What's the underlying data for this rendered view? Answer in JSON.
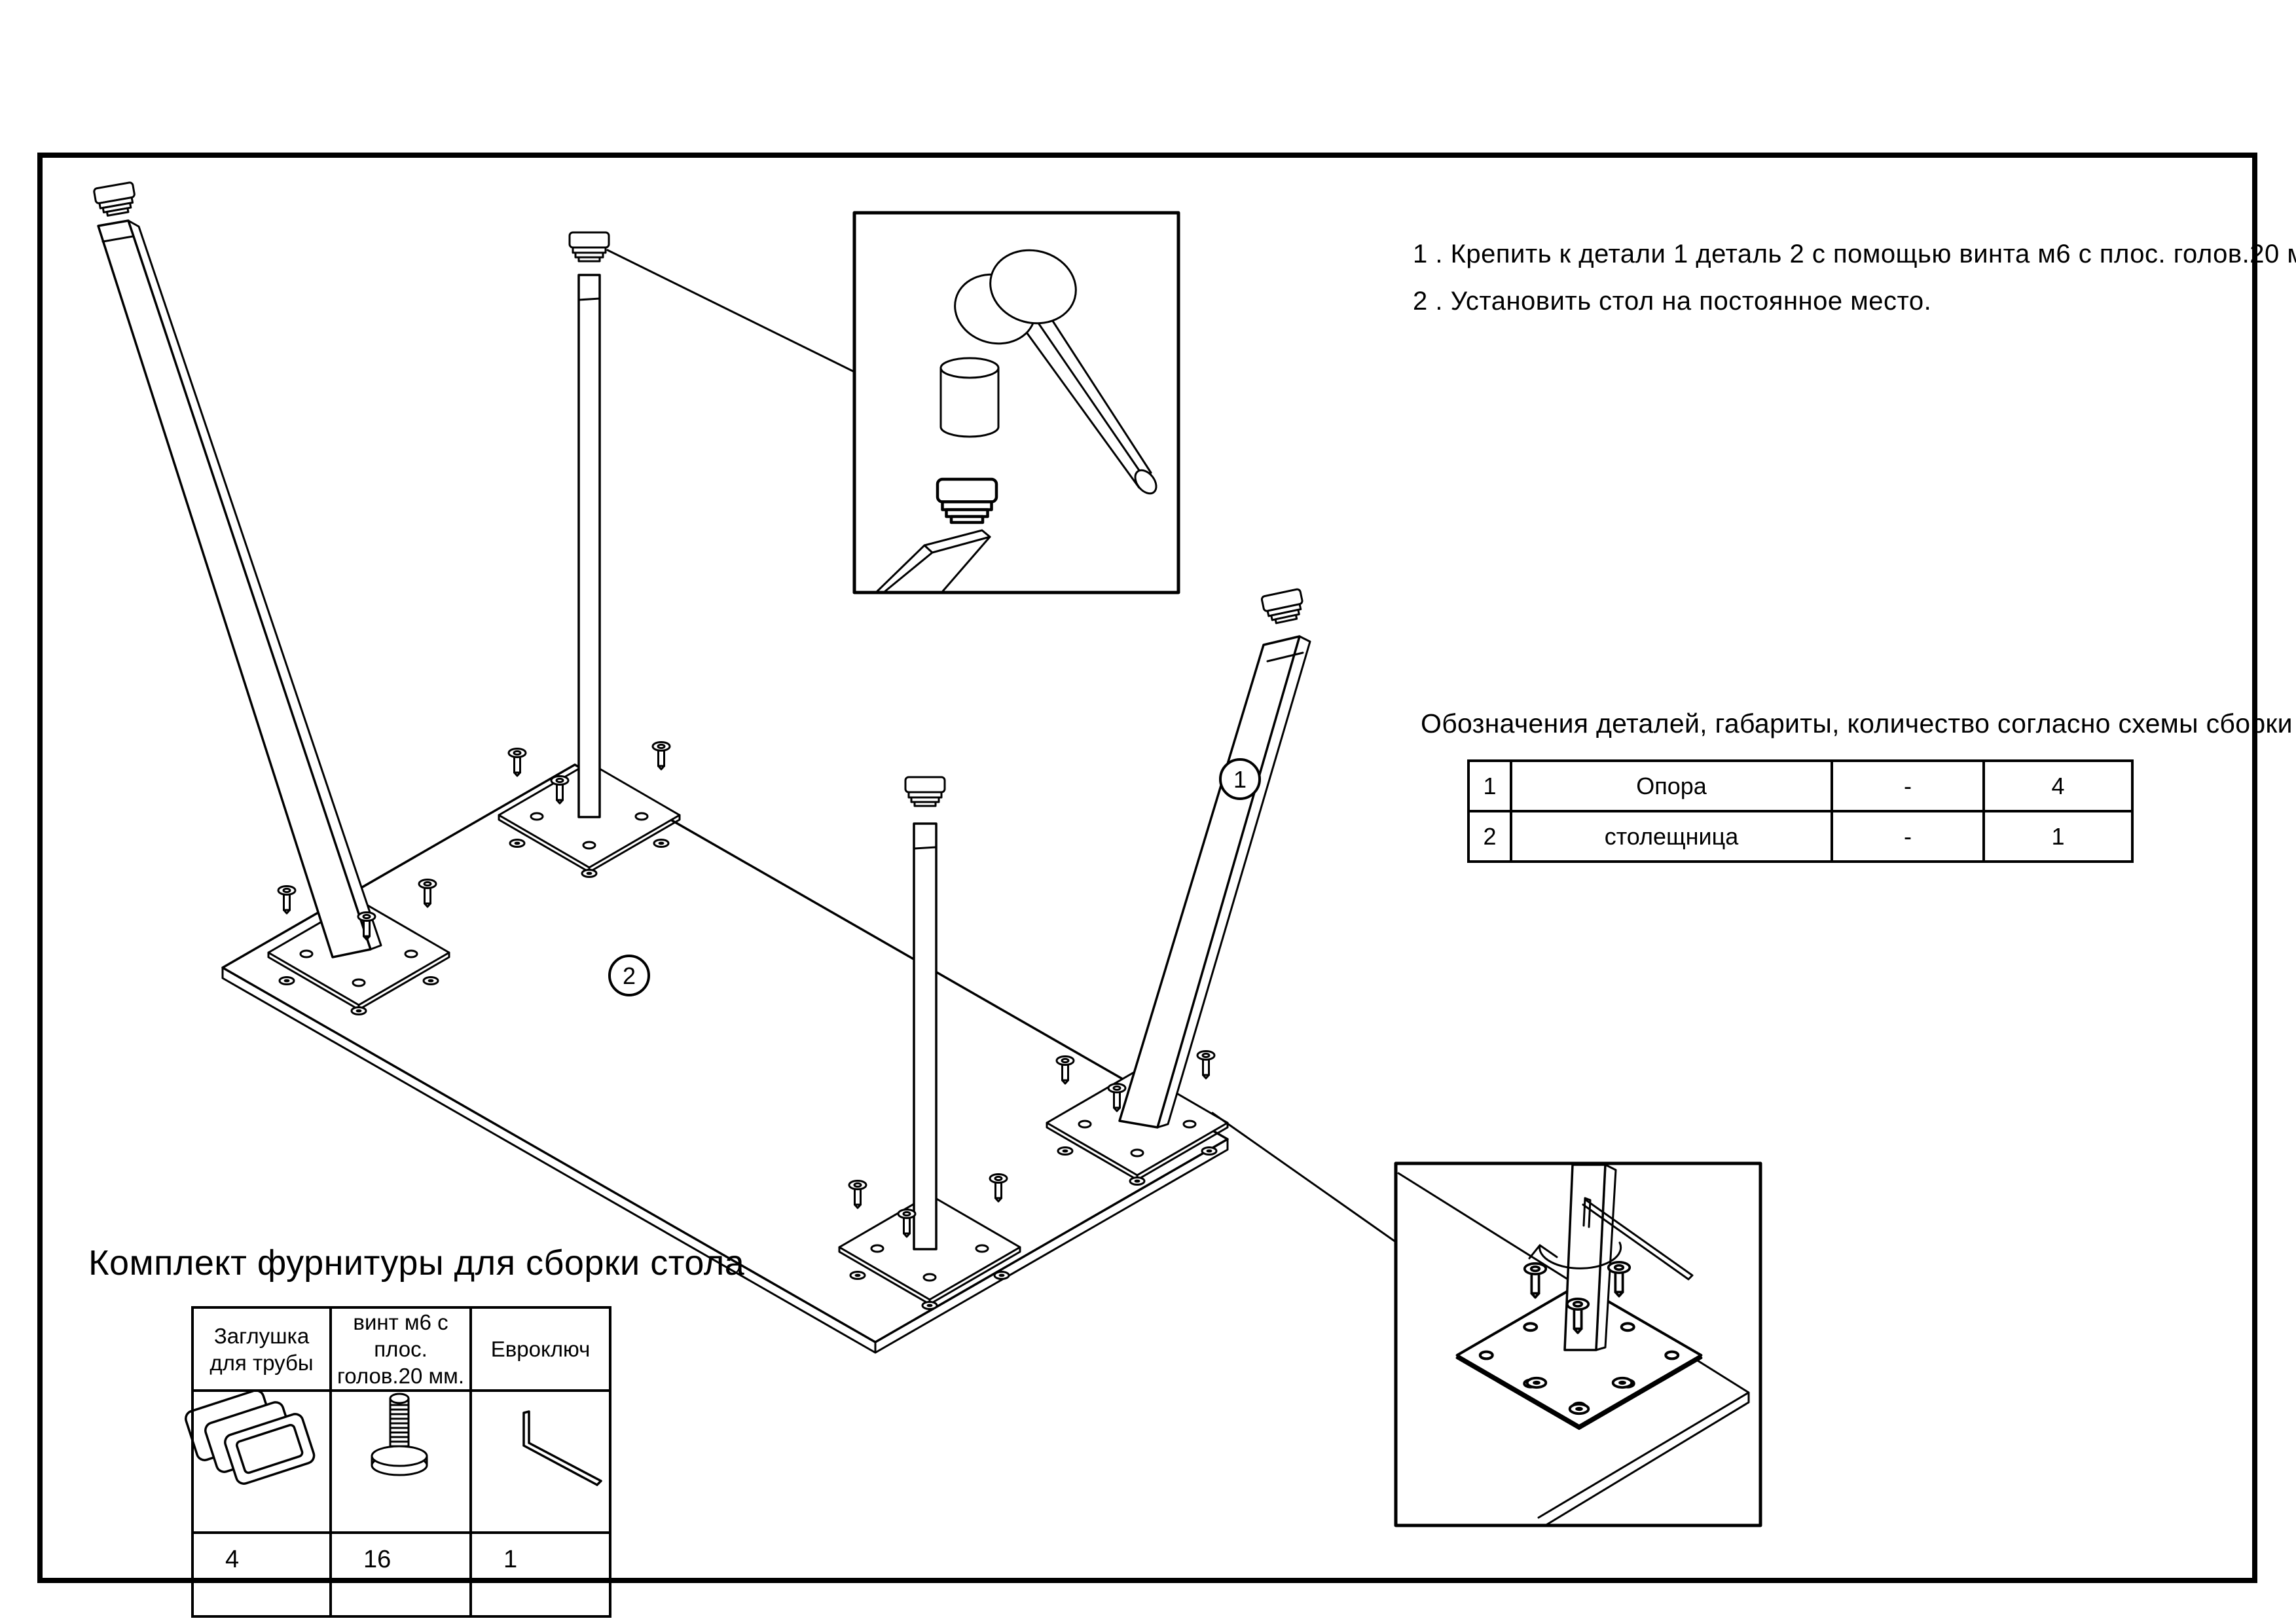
{
  "colors": {
    "line": "#000000",
    "background": "#ffffff"
  },
  "instructions": {
    "line1": "1 . Крепить к детали 1 деталь 2 с помощью винта м6 с плос. голов.20 мм.",
    "line2": "2 . Установить стол на постоянное место."
  },
  "parts_table": {
    "title": "Обозначения деталей, габариты, количество согласно схемы сборки",
    "rows": [
      {
        "num": "1",
        "name": "Опора",
        "dims": "-",
        "qty": "4"
      },
      {
        "num": "2",
        "name": "столещница",
        "dims": "-",
        "qty": "1"
      }
    ]
  },
  "hardware_kit": {
    "title": "Комплект фурнитуры для сборки стола",
    "columns": [
      {
        "icon": "tube-cap-icon",
        "lines": [
          "Заглушка",
          "для трубы"
        ],
        "qty": "4"
      },
      {
        "icon": "screw-icon",
        "lines": [
          "винт м6 с плос.",
          "голов.20 мм."
        ],
        "qty": "16"
      },
      {
        "icon": "hex-key-icon",
        "lines": [
          "Евроключ",
          ""
        ],
        "qty": "1"
      }
    ]
  },
  "labels": {
    "support": "1",
    "tabletop": "2"
  }
}
